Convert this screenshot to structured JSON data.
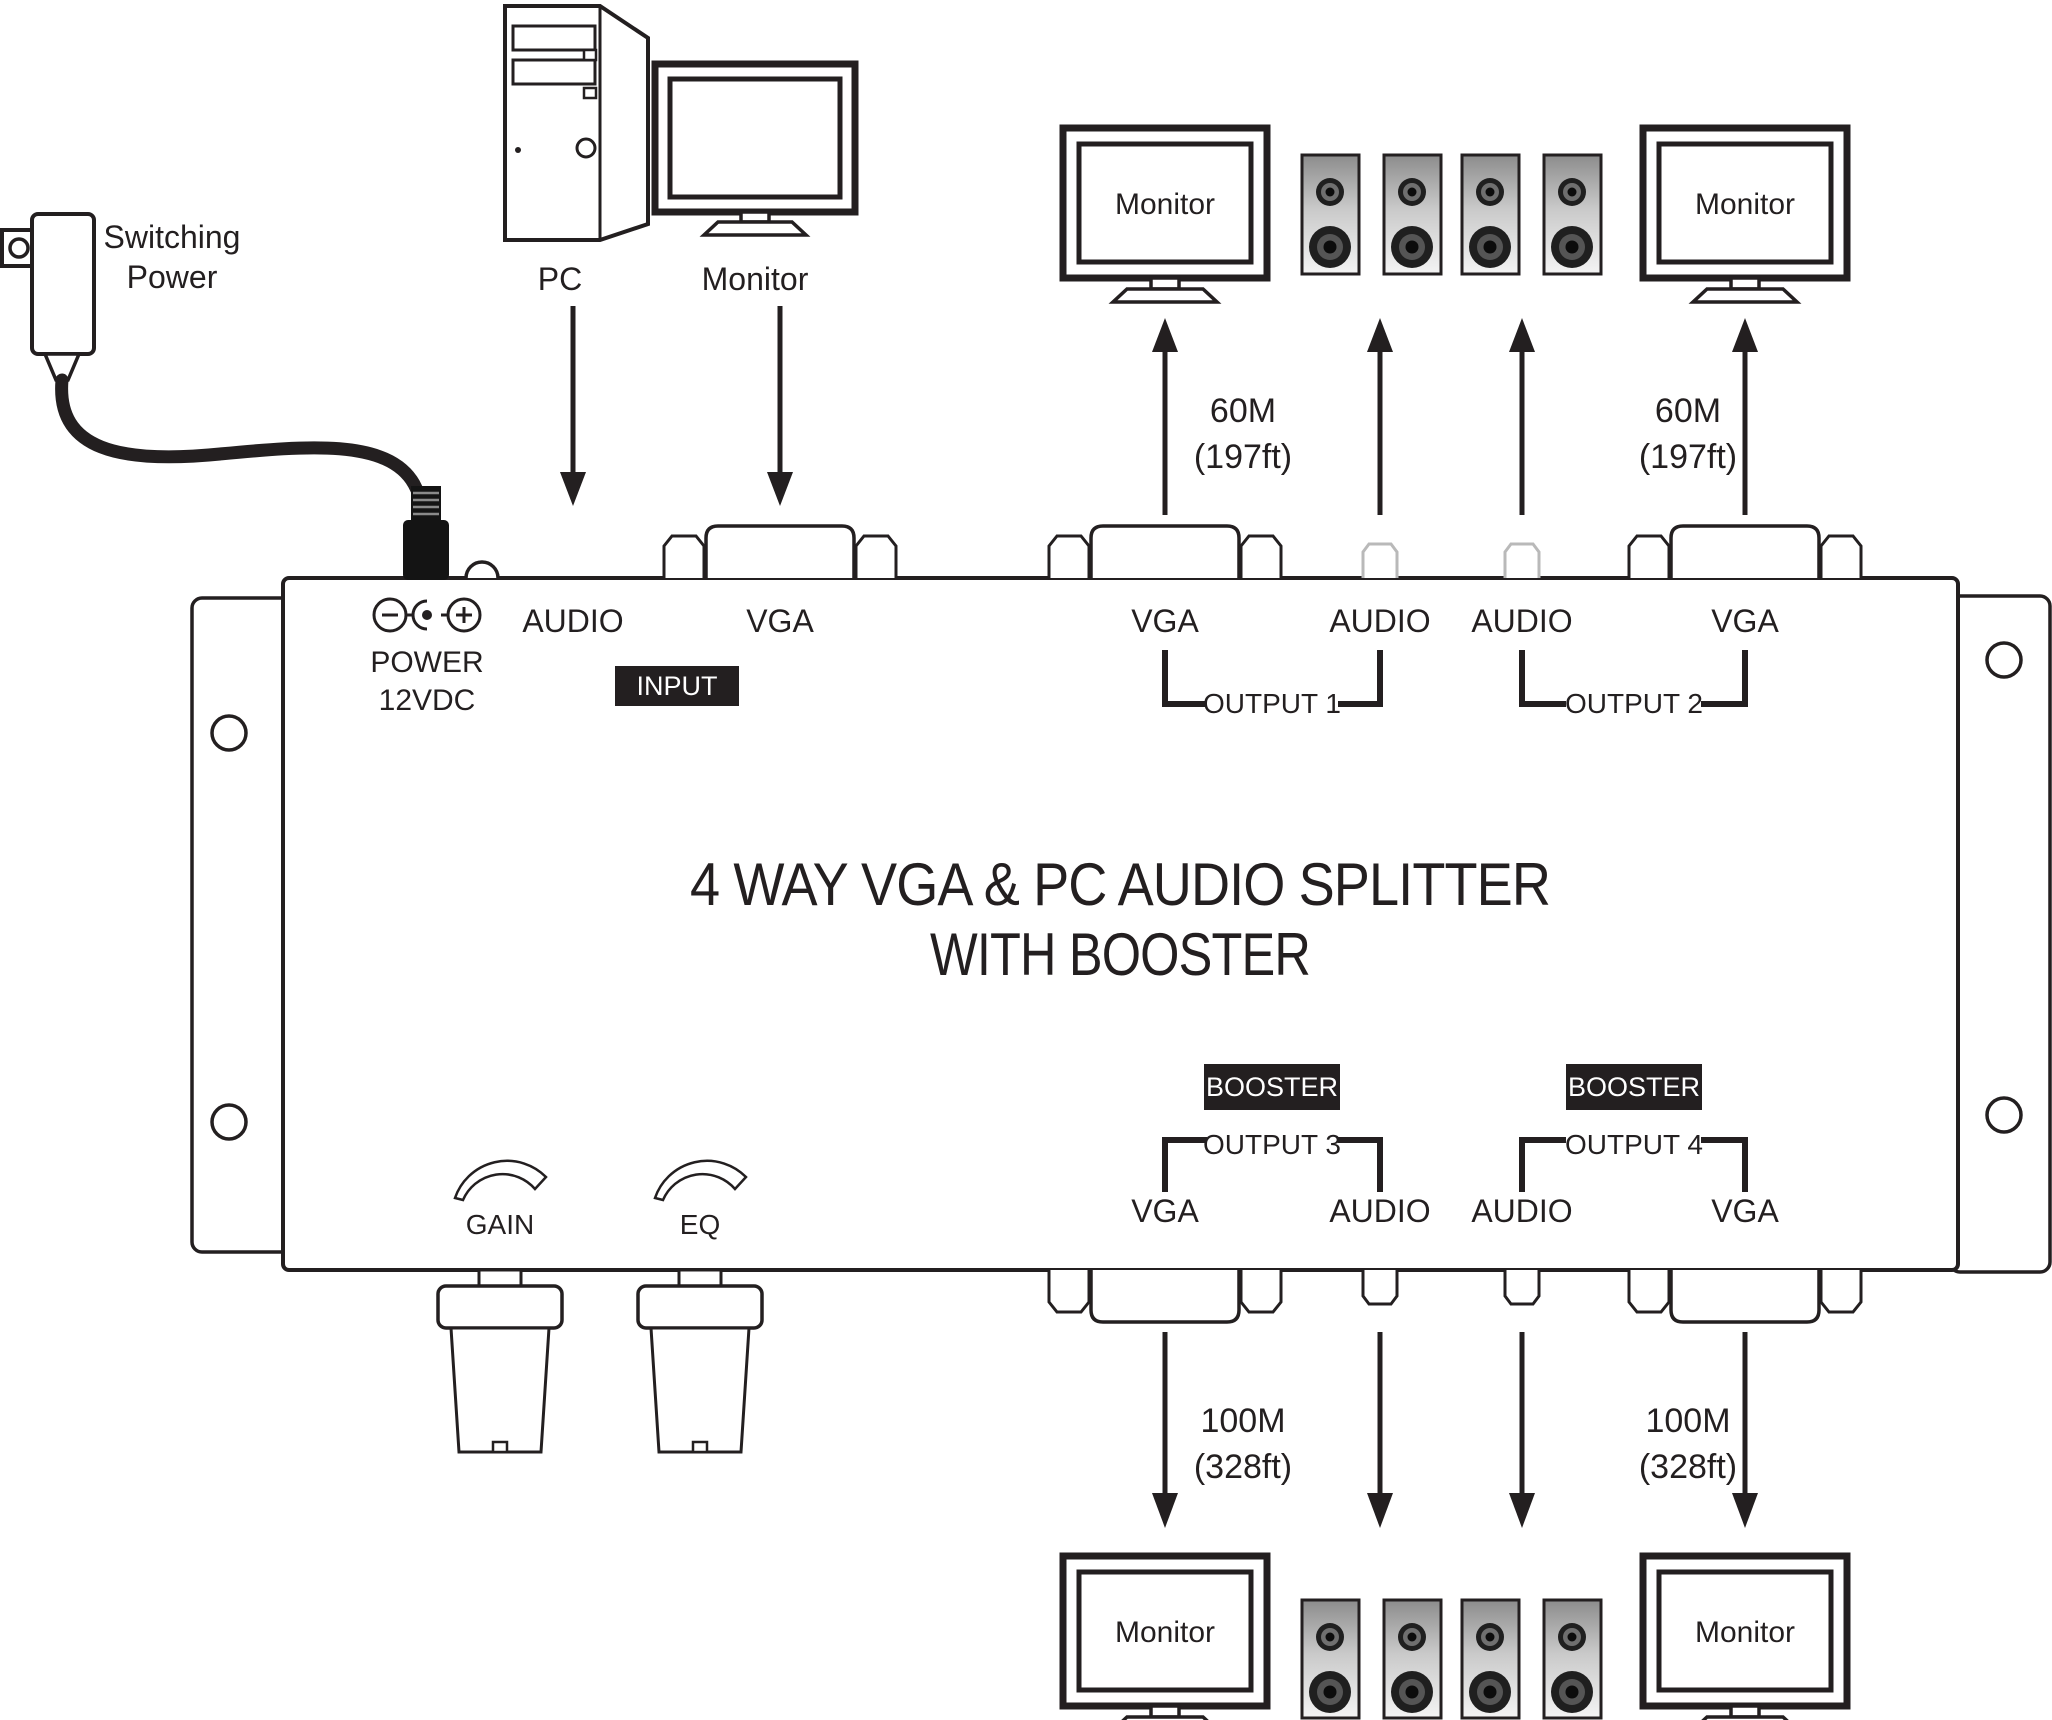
{
  "adapter": {
    "line1": "Switching",
    "line2": "Power"
  },
  "sources": {
    "pc": "PC",
    "monitor": "Monitor"
  },
  "device_box": {
    "power1": "POWER",
    "power2": "12VDC",
    "input_badge": "INPUT",
    "in_audio": "AUDIO",
    "in_vga": "VGA",
    "title1": "4 WAY VGA & PC AUDIO SPLITTER",
    "title2": "WITH BOOSTER",
    "gain": "GAIN",
    "eq": "EQ"
  },
  "output1": {
    "vga": "VGA",
    "audio": "AUDIO",
    "group": "OUTPUT 1",
    "dist_m": "60M",
    "dist_ft": "(197ft)",
    "monitor": "Monitor"
  },
  "output2": {
    "audio": "AUDIO",
    "vga": "VGA",
    "group": "OUTPUT 2",
    "dist_m": "60M",
    "dist_ft": "(197ft)",
    "monitor": "Monitor"
  },
  "output3": {
    "vga": "VGA",
    "audio": "AUDIO",
    "group": "OUTPUT 3",
    "booster": "BOOSTER",
    "dist_m": "100M",
    "dist_ft": "(328ft)",
    "monitor": "Monitor"
  },
  "output4": {
    "audio": "AUDIO",
    "vga": "VGA",
    "group": "OUTPUT 4",
    "booster": "BOOSTER",
    "dist_m": "100M",
    "dist_ft": "(328ft)",
    "monitor": "Monitor"
  },
  "colors": {
    "ink": "#231f20",
    "badge_bg": "#231f20",
    "badge_text": "#ffffff"
  }
}
